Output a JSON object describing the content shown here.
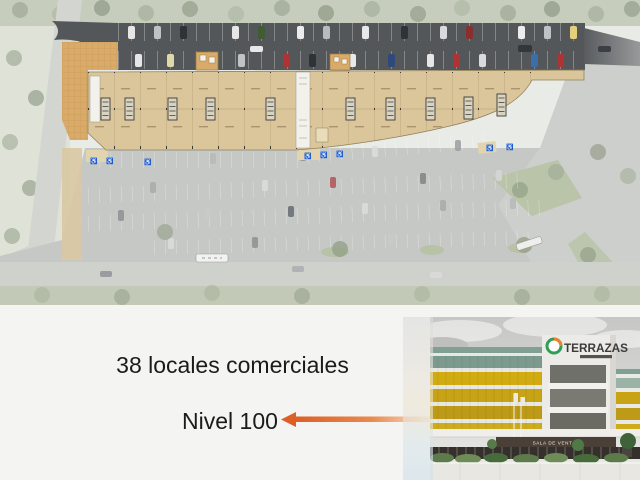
{
  "slide": {
    "line1": "38 locales comerciales",
    "line2": "Nivel 100"
  },
  "photo": {
    "logo": "TERRAZAS",
    "sala_sign": "SALA DE VENTAS"
  },
  "colors": {
    "arrow_orange": "#dc5f26",
    "building_beige": "#dbc69b",
    "asphalt_dark": "#54575a",
    "plaza_tan": "#d9ab6b",
    "facade_yellow": "#c9a315",
    "logo_green": "#2f9e57",
    "logo_orange": "#e8832a",
    "caption_text": "#1b1b1b",
    "slide_background": "#f4f4f2"
  }
}
